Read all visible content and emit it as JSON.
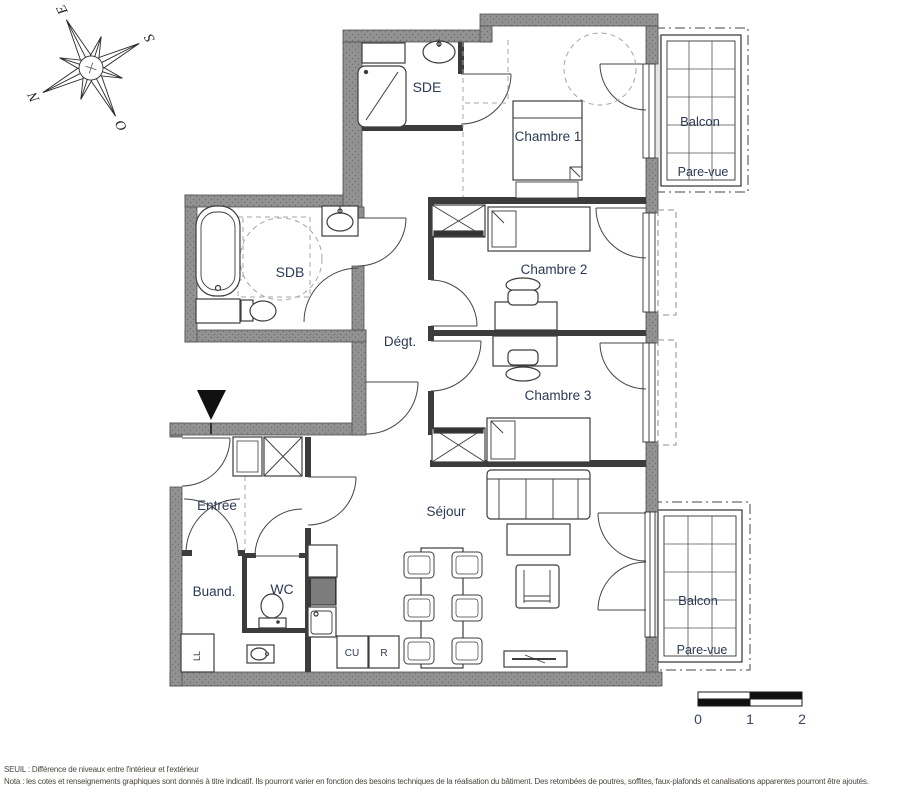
{
  "labels": {
    "sde": "SDE",
    "chambre1": "Chambre 1",
    "chambre2": "Chambre 2",
    "chambre3": "Chambre 3",
    "sdb": "SDB",
    "degt": "Dégt.",
    "entree": "Entrée",
    "sejour": "Séjour",
    "buand": "Buand.",
    "wc": "WC",
    "ll": "LL",
    "cu": "CU",
    "r": "R",
    "balcon_top": "Balcon",
    "balcon_bottom": "Balcon",
    "pare_vue_top": "Pare-vue",
    "pare_vue_bottom": "Pare-vue"
  },
  "compass": {
    "n": "N",
    "e": "E",
    "s": "S",
    "o": "O"
  },
  "scale_bar": {
    "tick0": "0",
    "tick1": "1",
    "tick2": "2"
  },
  "footer": {
    "line1": "SEUIL : Différence de niveaux entre l'intérieur et l'extérieur",
    "line2": "Nota : les cotes et renseignements graphiques sont donnés à titre indicatif. Ils pourront varier en fonction des besoins techniques de la réalisation du bâtiment. Des retombées de poutres, soffites, faux-plafonds et canalisations apparentes pourront être ajoutés."
  },
  "colors": {
    "wall": "#8f8f8f",
    "line": "#3c3c3c",
    "label": "#2b3a55",
    "dashed": "#9a9a9a"
  }
}
